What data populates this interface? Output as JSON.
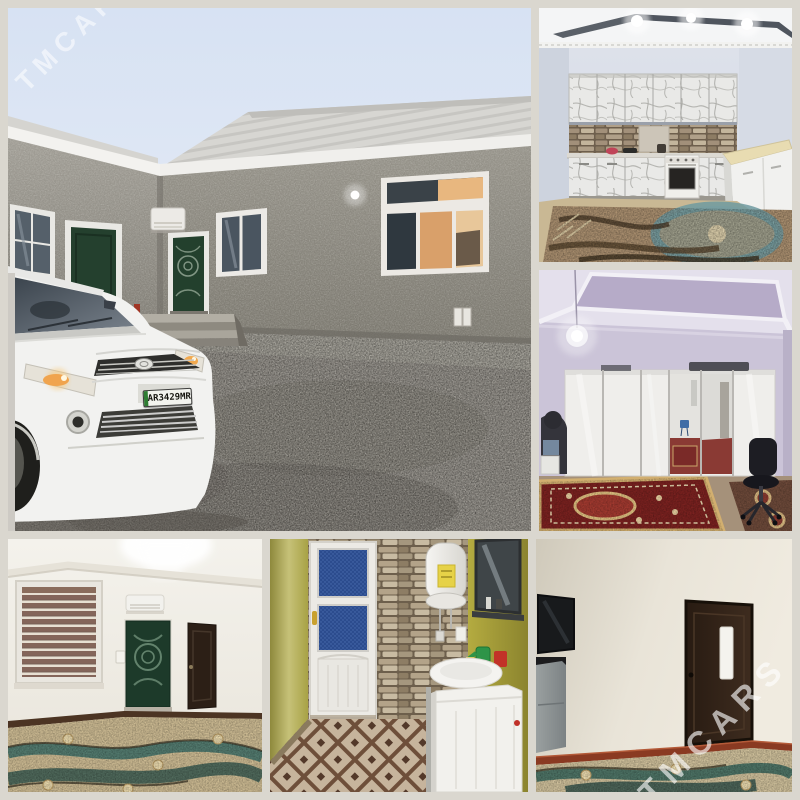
{
  "image_type": "real-estate-photo-collage",
  "watermarks": {
    "top_left": "TMCARS",
    "bottom_right": "TMCARS"
  },
  "license_plate": "AR3429MR",
  "photos": [
    {
      "label": "House exterior: gray stucco courtyard with green doors, white Toyota Corolla on gravel"
    },
    {
      "label": "Kitchen: marble-pattern cabinets, stone backsplash, gas stove, ornate rug"
    },
    {
      "label": "Bedroom: white mirrored wardrobe, hanging bulb, red oriental carpet, office chair"
    },
    {
      "label": "Hallway room: zebra-blind window, AC unit above green door, brown door, patterned carpet"
    },
    {
      "label": "Bathroom: white door with blue glass, stone wall, water heater, sink, washing machine"
    },
    {
      "label": "Living room: wall-mounted TV, gray stand, dark brown door, patterned carpet"
    }
  ],
  "palette": {
    "gutter": "#dad7cf",
    "sky": "#d7e2f3",
    "stucco_gray": "#8f8c85",
    "door_green": "#1d3a2a",
    "gravel": "#8e8a83",
    "lavender_wall": "#cbc4d8",
    "kitchen_wall": "#dfe3ec",
    "bath_wall_olive": "#b3a93f",
    "carpet_red": "#7c2220",
    "carpet_beige": "#cdbb93",
    "carpet_teal": "#47756d",
    "plate_green": "#2f7d33",
    "watermark": "#ffffff"
  }
}
